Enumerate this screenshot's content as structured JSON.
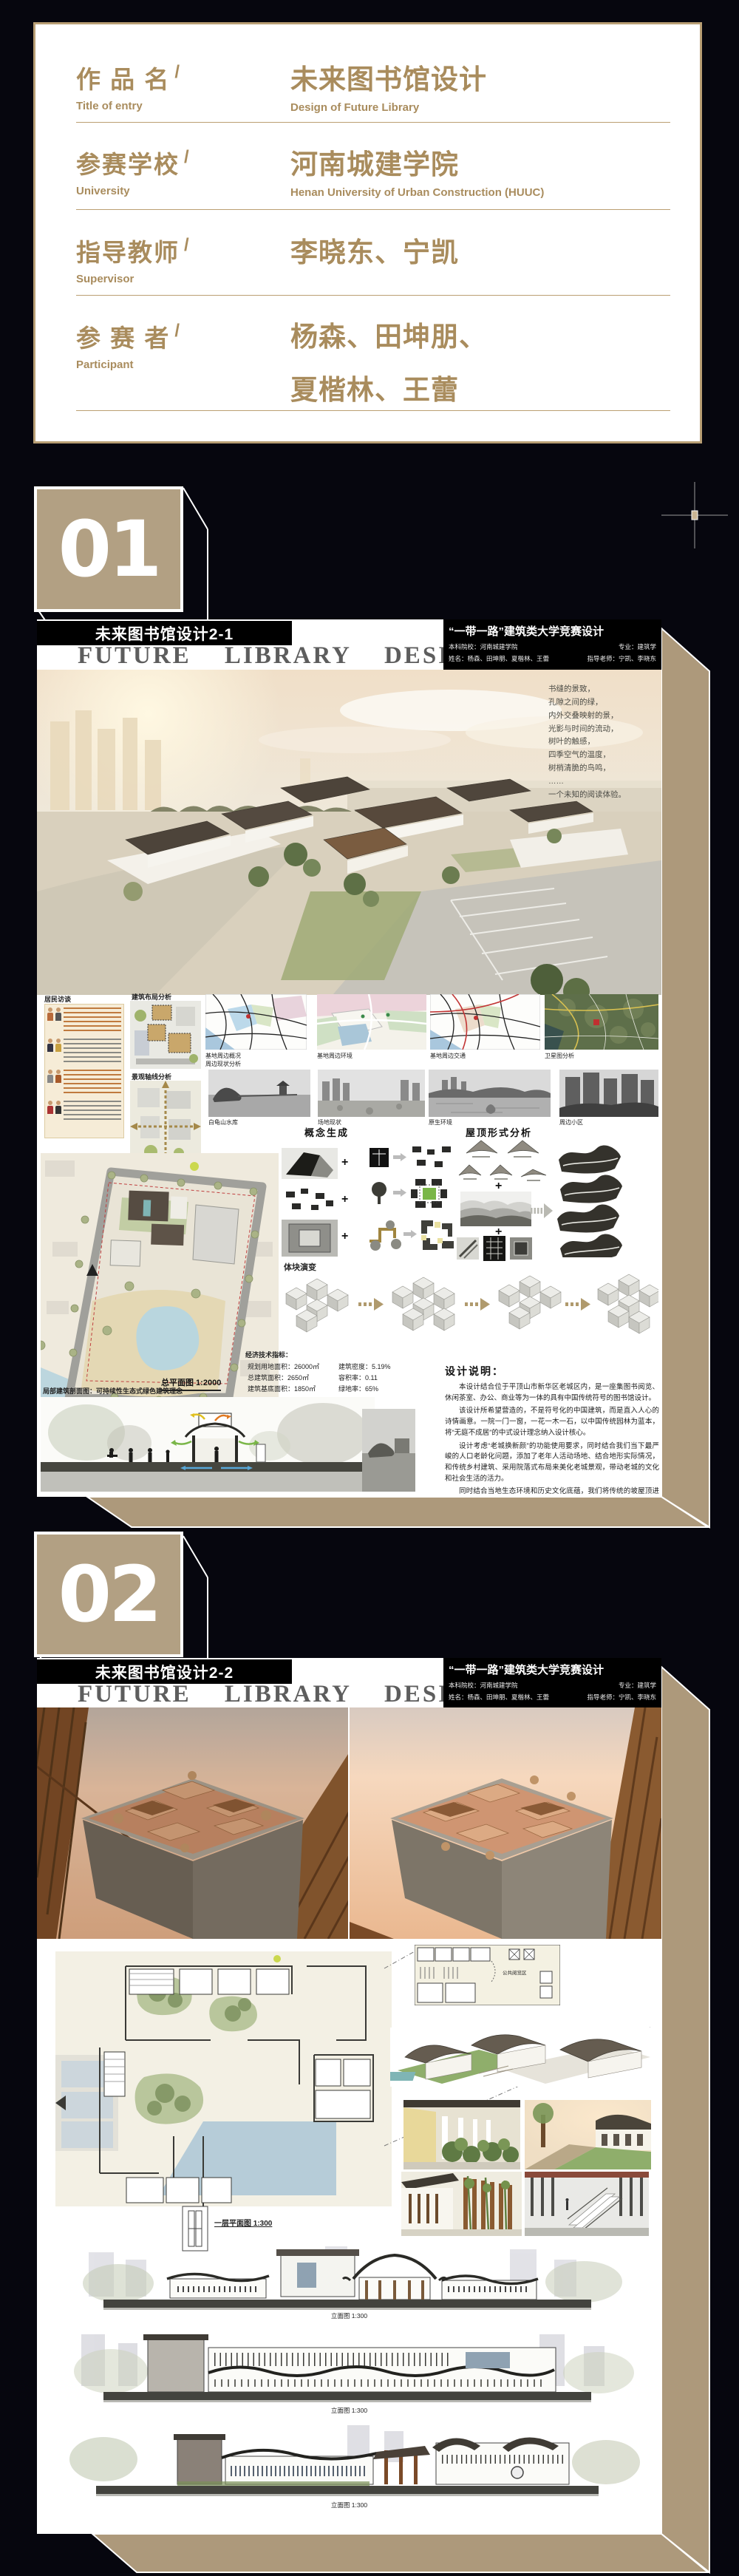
{
  "info_card": {
    "slash": "/",
    "rows": [
      {
        "zh": "作 品 名",
        "en": "Title of entry",
        "val_zh": "未来图书馆设计",
        "val_en": "Design of Future Library"
      },
      {
        "zh": "参赛学校",
        "en": "University",
        "val_zh": "河南城建学院",
        "val_en": "Henan University of Urban Construction (HUUC)"
      },
      {
        "zh": "指导教师",
        "en": "Supervisor",
        "val_zh": "李晓东、宁凯",
        "val_en": ""
      },
      {
        "zh": "参 赛 者",
        "en": "Participant",
        "val_zh": "杨森、田坤朋、",
        "val_zh2": "夏楷林、王蕾",
        "val_en": ""
      }
    ]
  },
  "badges": {
    "n1": "01",
    "n2": "02"
  },
  "poster_header": {
    "title_en": "FUTURE LIBRARY DESIGN",
    "competition": "“一带一路”建筑类大学竞赛设计",
    "school": "本科院校：河南城建学院",
    "major": "专业：建筑学",
    "names": "姓名：杨森、田坤朋、夏楷林、王蕾",
    "advisor": "指导老师：宁凯、李晓东"
  },
  "poster1": {
    "title": "未来图书馆设计2-1",
    "poem": [
      "书缝的景致，",
      "孔隙之间的绿，",
      "内外交叠映射的景，",
      "光影与时间的流动，",
      "树叶的触感，",
      "四季空气的温度，",
      "树梢清脆的鸟鸣，",
      "……",
      "一个未知的阅读体验。"
    ],
    "labels": {
      "interview": "居民访谈",
      "layout": "建筑布局分析",
      "axis": "景观轴线分析",
      "map1a": "基地周边概况",
      "map1b": "周边现状分析",
      "map2": "基地周边环境",
      "map3": "基地周边交通",
      "map4": "卫星图分析",
      "photo1": "白龟山水库",
      "photo2": "场地现状",
      "photo3": "原生环境",
      "photo4": "周边小区",
      "concept": "概念生成",
      "roof": "屋顶形式分析",
      "mass": "体块演变",
      "siteplan": "总平面图 1:2000",
      "section_caption": "局部建筑剖面图：可持续性生态式绿色建筑理念"
    },
    "indicators": {
      "title": "经济技术指标：",
      "col1": [
        "规划用地面积：26000㎡",
        "总建筑面积：2650㎡",
        "建筑基底面积：1850㎡"
      ],
      "col2": [
        "建筑密度：5.19%",
        "容积率：0.11",
        "绿地率：65%"
      ]
    },
    "statement": {
      "title": "设计说明：",
      "paragraphs": [
        "本设计结合位于平顶山市新华区老城区内，是一座集图书阅览、休闲茶室、办公、商业等为一体的具有中国传统符号的图书馆设计。",
        "该设计所希望营造的，不是符号化的中国建筑，而是直入人心的诗情画意。一院一门一窗，一花一木一石，以中国传统园林为蓝本，将“无庭不成居”的中式设计理念纳入设计核心。",
        "设计考虑“老城换新颜”的功能使用要求，同时结合我们当下最严峻的人口老龄化问题，添加了老年人活动场地、结合地形实际情况，和传统乡村建筑、采用院落式布局来美化老城景观，带动老城的文化和社会生活的活力。",
        "同时结合当地生态环境和历史文化底蕴，我们将传统的坡屋顶进行演变，并增加了侧向采光与天窗设计，使整体建筑更有现代感与动感，赋予老城区新动力、新生机，同时希望该设计成为老城区面对新方向、新未来的“催化剂”。"
      ]
    }
  },
  "poster2": {
    "title": "未来图书馆设计2-2",
    "labels": {
      "floor1": "一层平面图 1:300",
      "floor2_room": "公共阅览区",
      "elev1": "立面图 1:300",
      "elev2": "立面图 1:300",
      "elev3": "立面图 1:300"
    }
  }
}
